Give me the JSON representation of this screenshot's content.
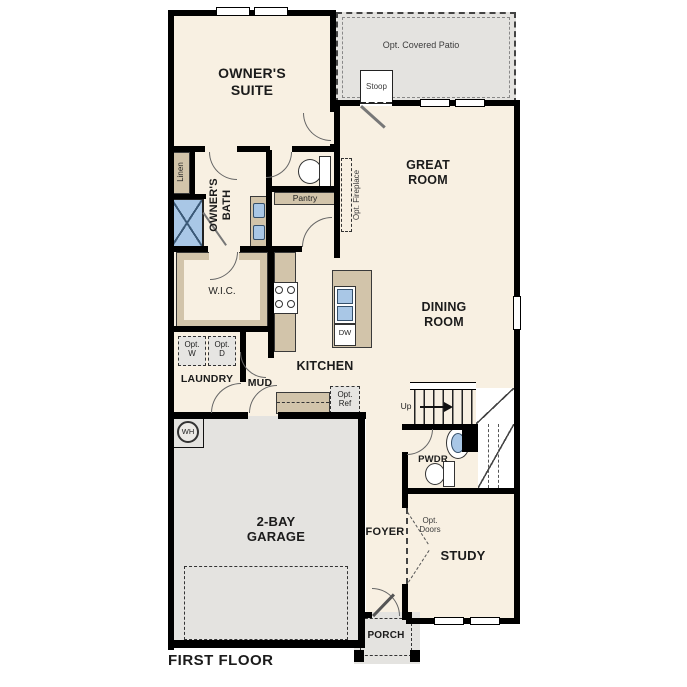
{
  "floor_plan": {
    "title": "FIRST FLOOR",
    "rooms": {
      "owners_suite": "OWNER'S\nSUITE",
      "owners_bath": "OWNER'S\nBATH",
      "linen": "Linen",
      "wic": "W.I.C.",
      "pantry": "Pantry",
      "great_room": "GREAT\nROOM",
      "dining_room": "DINING\nROOM",
      "kitchen": "KITCHEN",
      "laundry": "LAUNDRY",
      "mud": "MUD",
      "pwdr": "PWDR",
      "foyer": "FOYER",
      "study": "STUDY",
      "garage": "2-BAY\nGARAGE",
      "porch": "PORCH",
      "stoop": "Stoop"
    },
    "options": {
      "covered_patio": "Opt. Covered Patio",
      "fireplace": "Opt. Fireplace",
      "washer": "Opt.\nW",
      "dryer": "Opt.\nD",
      "refrigerator": "Opt.\nRef",
      "doors": "Opt.\nDoors"
    },
    "fixtures": {
      "water_heater": "WH",
      "dishwasher": "DW"
    },
    "stairs": {
      "up": "Up"
    },
    "colors": {
      "wall": "#000000",
      "floor": "#f8f0e2",
      "outdoor": "#e4e3e0",
      "cabinet": "#d2c4aa",
      "fixture_blue": "#a9c7e6"
    }
  }
}
